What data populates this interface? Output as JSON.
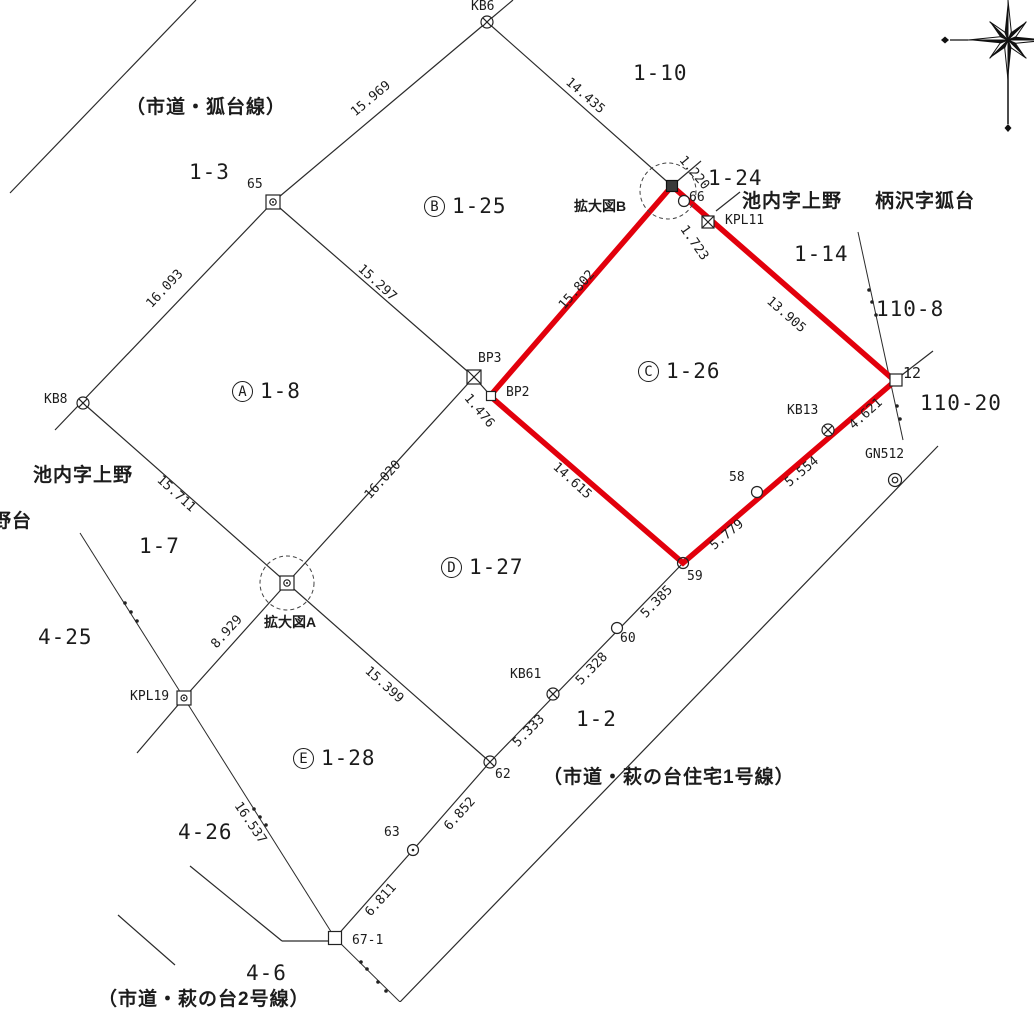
{
  "roads": {
    "kitsunedai": "（市道・狐台線）",
    "haginodai": "（市道・萩の台住宅1号線）",
    "bottom": "（市道・萩の台2号線）"
  },
  "areas": {
    "ikenouchi_left": "池内字上野",
    "nodai": "野台",
    "ikenouchi_right": "池内字上野",
    "karasawa": "柄沢字狐台"
  },
  "blocks": {
    "a": {
      "letter": "A",
      "number": "1-8"
    },
    "b": {
      "letter": "B",
      "number": "1-25"
    },
    "c": {
      "letter": "C",
      "number": "1-26"
    },
    "d": {
      "letter": "D",
      "number": "1-27"
    },
    "e": {
      "letter": "E",
      "number": "1-28"
    }
  },
  "parcels": {
    "p1_10": "1-10",
    "p1_3": "1-3",
    "p1_24": "1-24",
    "p1_14": "1-14",
    "p110_8": "110-8",
    "p110_20": "110-20",
    "p1_7": "1-7",
    "p4_25": "4-25",
    "p1_2": "1-2",
    "p4_26": "4-26",
    "p4_6": "4-6"
  },
  "points": {
    "kb6": "KB6",
    "p65": "65",
    "kb8": "KB8",
    "bp3": "BP3",
    "bp2": "BP2",
    "p66": "66",
    "kpl11": "KPL11",
    "p12": "12",
    "kb13": "KB13",
    "gn512": "GN512",
    "p58": "58",
    "p59": "59",
    "p60": "60",
    "kb61": "KB61",
    "p62": "62",
    "p63": "63",
    "p67_1": "67-1",
    "kpl19": "KPL19"
  },
  "expand": {
    "a": "拡大図A",
    "b": "拡大図B"
  },
  "measurements": {
    "m15_969": "15.969",
    "m14_435": "14.435",
    "m16_093": "16.093",
    "m15_297": "15.297",
    "m15_802": "15.802",
    "m13_905": "13.905",
    "m1_220": "1.220",
    "m1_723": "1.723",
    "m1_476": "1.476",
    "m16_020": "16.020",
    "m15_711": "15.711",
    "m14_615": "14.615",
    "m8_929": "8.929",
    "m15_399": "15.399",
    "m16_537": "16.537",
    "m4_621": "4.621",
    "m5_554": "5.554",
    "m5_779": "5.779",
    "m5_385": "5.385",
    "m5_328": "5.328",
    "m5_333": "5.333",
    "m6_852": "6.852",
    "m6_811": "6.811"
  },
  "colors": {
    "highlight_red": "#e2000c",
    "line_black": "#2b2b2b"
  }
}
